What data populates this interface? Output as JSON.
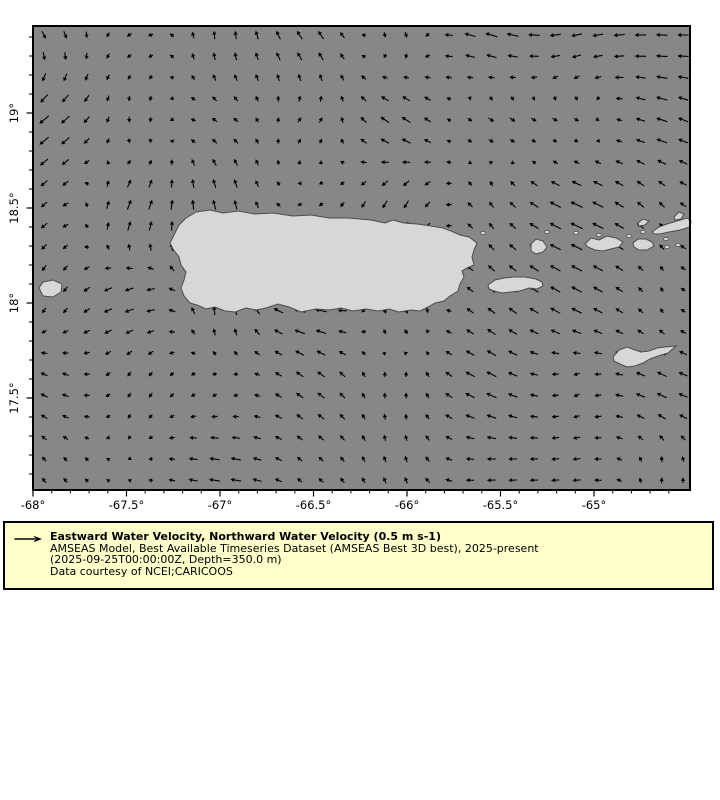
{
  "figure": {
    "width": 720,
    "height": 800,
    "background": "#ffffff"
  },
  "map": {
    "frame": {
      "x": 33,
      "y": 26,
      "width": 657,
      "height": 464
    },
    "sea_color": "#878787",
    "land_color": "#d7d7d7",
    "coast_color": "#4c4c4c",
    "frame_color": "#000000",
    "tick_color": "#000000",
    "label_color": "#000000",
    "projection": {
      "lon0": -68,
      "px_per_lon": 187,
      "lat0": 17.5,
      "y_lat0": 372,
      "px_per_lat": 190
    },
    "x_axis": {
      "major_ticks": [
        {
          "lon": -68,
          "label": "-68°"
        },
        {
          "lon": -67.5,
          "label": "-67.5°"
        },
        {
          "lon": -67,
          "label": "-67°"
        },
        {
          "lon": -66.5,
          "label": "-66.5°"
        },
        {
          "lon": -66,
          "label": "-66°"
        },
        {
          "lon": -65.5,
          "label": "-65.5°"
        },
        {
          "lon": -65,
          "label": "-65°"
        }
      ],
      "minor_step": 0.1
    },
    "y_axis": {
      "major_ticks": [
        {
          "lat": 19,
          "label": "19°"
        },
        {
          "lat": 18.5,
          "label": "18.5°"
        },
        {
          "lat": 18,
          "label": "18°"
        },
        {
          "lat": 17.5,
          "label": "17.5°"
        }
      ],
      "minor_step": 0.1
    },
    "islands": [
      {
        "name": "puerto-rico",
        "points": [
          [
            137,
            217
          ],
          [
            141,
            209
          ],
          [
            146,
            199
          ],
          [
            153,
            192
          ],
          [
            163,
            186
          ],
          [
            177,
            184
          ],
          [
            190,
            187
          ],
          [
            205,
            185
          ],
          [
            222,
            188
          ],
          [
            240,
            187
          ],
          [
            260,
            190
          ],
          [
            278,
            189
          ],
          [
            296,
            192
          ],
          [
            315,
            192
          ],
          [
            338,
            194
          ],
          [
            352,
            197
          ],
          [
            360,
            194
          ],
          [
            371,
            197
          ],
          [
            384,
            198
          ],
          [
            398,
            200
          ],
          [
            410,
            202
          ],
          [
            418,
            205
          ],
          [
            427,
            209
          ],
          [
            436,
            211
          ],
          [
            444,
            217
          ],
          [
            441,
            224
          ],
          [
            439,
            231
          ],
          [
            441,
            239
          ],
          [
            434,
            242
          ],
          [
            429,
            245
          ],
          [
            431,
            251
          ],
          [
            427,
            258
          ],
          [
            425,
            265
          ],
          [
            417,
            270
          ],
          [
            411,
            275
          ],
          [
            402,
            277
          ],
          [
            395,
            281
          ],
          [
            387,
            285
          ],
          [
            378,
            284
          ],
          [
            366,
            286
          ],
          [
            356,
            283
          ],
          [
            345,
            285
          ],
          [
            333,
            283
          ],
          [
            320,
            285
          ],
          [
            308,
            282
          ],
          [
            296,
            284
          ],
          [
            283,
            283
          ],
          [
            268,
            286
          ],
          [
            256,
            281
          ],
          [
            245,
            278
          ],
          [
            233,
            282
          ],
          [
            223,
            284
          ],
          [
            213,
            282
          ],
          [
            202,
            286
          ],
          [
            192,
            285
          ],
          [
            182,
            281
          ],
          [
            173,
            283
          ],
          [
            164,
            279
          ],
          [
            157,
            277
          ],
          [
            151,
            270
          ],
          [
            148,
            262
          ],
          [
            151,
            254
          ],
          [
            153,
            246
          ],
          [
            148,
            239
          ],
          [
            146,
            231
          ],
          [
            140,
            223
          ]
        ]
      },
      {
        "name": "mona",
        "points": [
          [
            6,
            262
          ],
          [
            10,
            256
          ],
          [
            20,
            254
          ],
          [
            29,
            258
          ],
          [
            28,
            266
          ],
          [
            20,
            271
          ],
          [
            10,
            270
          ]
        ]
      },
      {
        "name": "vieques",
        "points": [
          [
            455,
            259
          ],
          [
            462,
            254
          ],
          [
            471,
            252
          ],
          [
            481,
            251
          ],
          [
            492,
            251
          ],
          [
            503,
            253
          ],
          [
            509,
            256
          ],
          [
            510,
            260
          ],
          [
            504,
            263
          ],
          [
            496,
            262
          ],
          [
            487,
            265
          ],
          [
            478,
            266
          ],
          [
            469,
            267
          ],
          [
            461,
            265
          ],
          [
            456,
            263
          ]
        ]
      },
      {
        "name": "culebra",
        "points": [
          [
            498,
            218
          ],
          [
            503,
            213
          ],
          [
            510,
            215
          ],
          [
            514,
            221
          ],
          [
            510,
            226
          ],
          [
            503,
            228
          ],
          [
            498,
            225
          ]
        ]
      },
      {
        "name": "st-thomas",
        "points": [
          [
            552,
            218
          ],
          [
            558,
            212
          ],
          [
            566,
            214
          ],
          [
            574,
            210
          ],
          [
            583,
            212
          ],
          [
            590,
            216
          ],
          [
            586,
            221
          ],
          [
            578,
            223
          ],
          [
            570,
            225
          ],
          [
            562,
            224
          ],
          [
            555,
            221
          ]
        ]
      },
      {
        "name": "st-john",
        "points": [
          [
            600,
            217
          ],
          [
            605,
            213
          ],
          [
            613,
            213
          ],
          [
            619,
            216
          ],
          [
            621,
            220
          ],
          [
            614,
            224
          ],
          [
            606,
            224
          ],
          [
            601,
            221
          ]
        ]
      },
      {
        "name": "tortola",
        "points": [
          [
            619,
            206
          ],
          [
            626,
            201
          ],
          [
            634,
            198
          ],
          [
            644,
            195
          ],
          [
            654,
            192
          ],
          [
            658,
            195
          ],
          [
            657,
            201
          ],
          [
            647,
            204
          ],
          [
            636,
            206
          ],
          [
            627,
            208
          ],
          [
            621,
            208
          ]
        ]
      },
      {
        "name": "jost-van-dyke",
        "points": [
          [
            605,
            197
          ],
          [
            610,
            193
          ],
          [
            616,
            195
          ],
          [
            612,
            199
          ],
          [
            606,
            200
          ]
        ]
      },
      {
        "name": "virgin-gorda",
        "points": [
          [
            641,
            191
          ],
          [
            646,
            186
          ],
          [
            651,
            188
          ],
          [
            648,
            193
          ],
          [
            642,
            194
          ]
        ]
      },
      {
        "name": "st-croix",
        "points": [
          [
            580,
            331
          ],
          [
            586,
            324
          ],
          [
            594,
            321
          ],
          [
            602,
            324
          ],
          [
            608,
            326
          ],
          [
            616,
            325
          ],
          [
            624,
            322
          ],
          [
            632,
            321
          ],
          [
            643,
            320
          ],
          [
            635,
            327
          ],
          [
            625,
            330
          ],
          [
            617,
            333
          ],
          [
            610,
            337
          ],
          [
            602,
            340
          ],
          [
            594,
            341
          ],
          [
            587,
            338
          ],
          [
            581,
            335
          ]
        ]
      }
    ],
    "islets": [
      [
        450,
        207
      ],
      [
        514,
        206
      ],
      [
        543,
        207
      ],
      [
        566,
        209
      ],
      [
        596,
        210
      ],
      [
        610,
        206
      ],
      [
        633,
        213
      ],
      [
        634,
        221
      ],
      [
        645,
        219
      ]
    ]
  },
  "quiver": {
    "x0": 11,
    "y0": 9,
    "dx": 21.3,
    "dy": 21.2,
    "cols": 31,
    "rows": 22,
    "color": "#000000",
    "seed": 7,
    "noise_scale": 0.24,
    "min_len": 3.5,
    "max_len": 14.5,
    "reference_value": "0.5 m s-1"
  },
  "legend": {
    "background": "#ffffcc",
    "border_color": "#000000",
    "arrow_color": "#000000",
    "title": "Eastward Water Velocity, Northward Water Velocity (0.5 m s-1)",
    "dataset_line": "AMSEAS Model, Best Available Timeseries Dataset (AMSEAS Best 3D best), 2025-present",
    "time_depth_line": "(2025-09-25T00:00:00Z, Depth=350.0 m)",
    "courtesy_line": "Data courtesy of NCEI;CARICOOS"
  }
}
